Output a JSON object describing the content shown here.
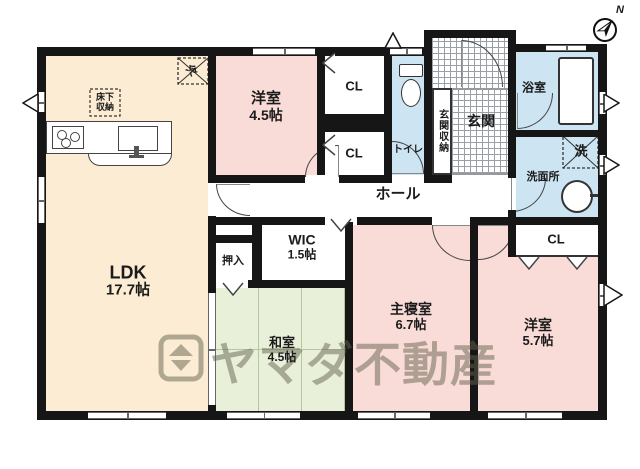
{
  "plan": {
    "compass_label": "N",
    "watermark": "ヤマダ不動産",
    "rooms": {
      "ldk": {
        "name": "LDK",
        "size": "17.7帖"
      },
      "yoshitsu45": {
        "name": "洋室",
        "size": "4.5帖"
      },
      "washitsu": {
        "name": "和室",
        "size": "4.5帖"
      },
      "shushinshitsu": {
        "name": "主寝室",
        "size": "6.7帖"
      },
      "yoshitsu57": {
        "name": "洋室",
        "size": "5.7帖"
      },
      "wic": {
        "name": "WIC",
        "size": "1.5帖"
      },
      "hall": {
        "name": "ホール"
      },
      "genkan": {
        "name": "玄関"
      },
      "genkan_shunou": {
        "name": "玄関収納"
      },
      "toilet": {
        "name": "トイレ"
      },
      "bathroom": {
        "name": "浴室"
      },
      "senmenjo": {
        "name": "洗面所"
      },
      "oshiire": {
        "name": "押入"
      },
      "closet_a": {
        "name": "CL"
      },
      "closet_b": {
        "name": "CL"
      },
      "closet_c": {
        "name": "CL"
      }
    },
    "fixtures": {
      "refrigerator": "冷",
      "washing_machine": "洗",
      "underfloor_storage_line1": "床下",
      "underfloor_storage_line2": "収納"
    },
    "colors": {
      "wall": "#161616",
      "ldk_floor": "#fbecd3",
      "western_room_floor": "#f9dcd7",
      "tatami_floor": "#e9f0da",
      "wet_area_floor": "#cde4f2",
      "watermark": "rgba(100,97,78,0.5)"
    }
  }
}
